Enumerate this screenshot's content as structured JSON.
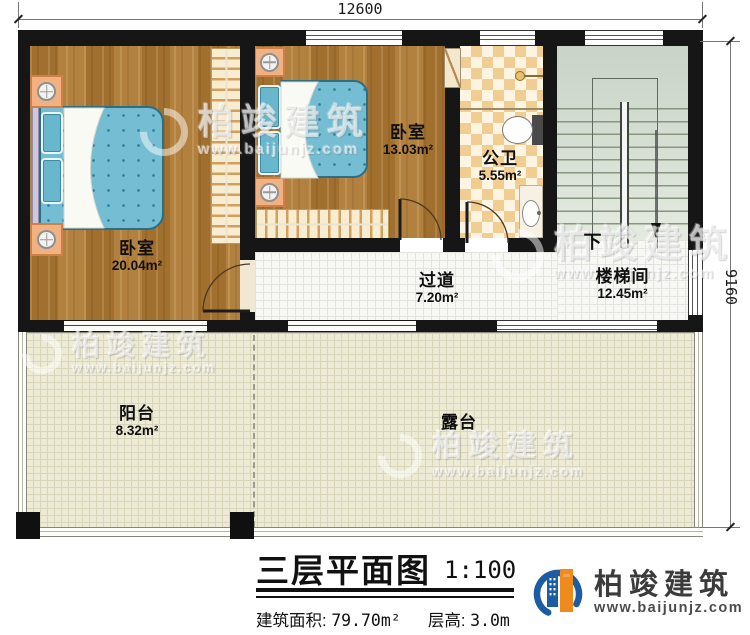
{
  "plan": {
    "dimensions": {
      "top": "12600",
      "right": "9160"
    },
    "rooms": [
      {
        "name": "卧室",
        "area": "20.04m²"
      },
      {
        "name": "卧室",
        "area": "13.03m²"
      },
      {
        "name": "公卫",
        "area": "5.55m²"
      },
      {
        "name": "过道",
        "area": "7.20m²"
      },
      {
        "name": "楼梯间",
        "area": "12.45m²"
      },
      {
        "name": "阳台",
        "area": "8.32m²"
      },
      {
        "name": "露台",
        "area": ""
      }
    ],
    "stair_direction": "下"
  },
  "title_block": {
    "title": "三层平面图",
    "scale": "1:100",
    "area_label": "建筑面积:",
    "area_value": "79.70m²",
    "floor_height_label": "层高:",
    "floor_height_value": "3.0m"
  },
  "brand": {
    "name": "柏竣建筑",
    "url": "www.baijunjz.com"
  },
  "watermark": {
    "name": "柏竣建筑",
    "url": "www.baijunjz.com"
  }
}
